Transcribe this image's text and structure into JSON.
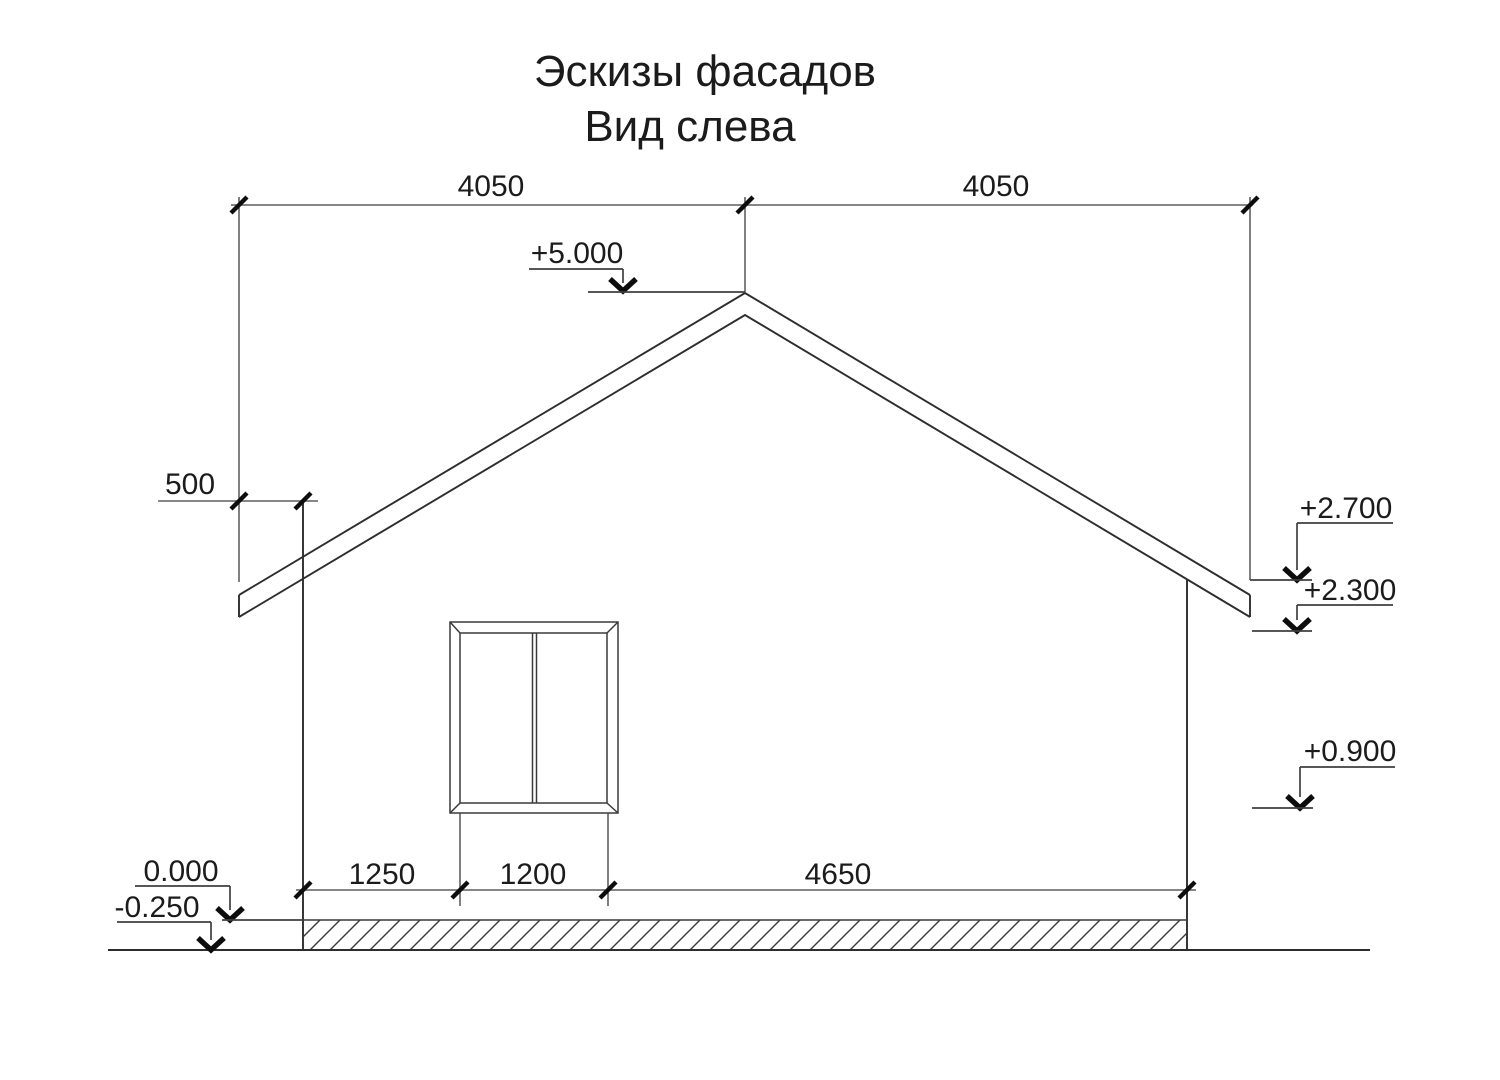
{
  "title": {
    "line1": "Эскизы фасадов",
    "line2": "Вид слева"
  },
  "dimensions": {
    "roof_left_half": "4050",
    "roof_right_half": "4050",
    "eave_overhang": "500",
    "wall_to_window": "1250",
    "window_width": "1200",
    "window_to_right_wall": "4650"
  },
  "elevations": {
    "ridge": "+5.000",
    "eave_top": "+2.700",
    "eave_bottom": "+2.300",
    "window_sill": "+0.900",
    "floor_level": "0.000",
    "ground_level": "-0.250"
  },
  "colors": {
    "background": "#ffffff",
    "drawing_line": "#2d2d2d",
    "dimension_line": "#5f5f5f",
    "marker_black": "#0d0d0d",
    "text": "#1b1b1b"
  }
}
